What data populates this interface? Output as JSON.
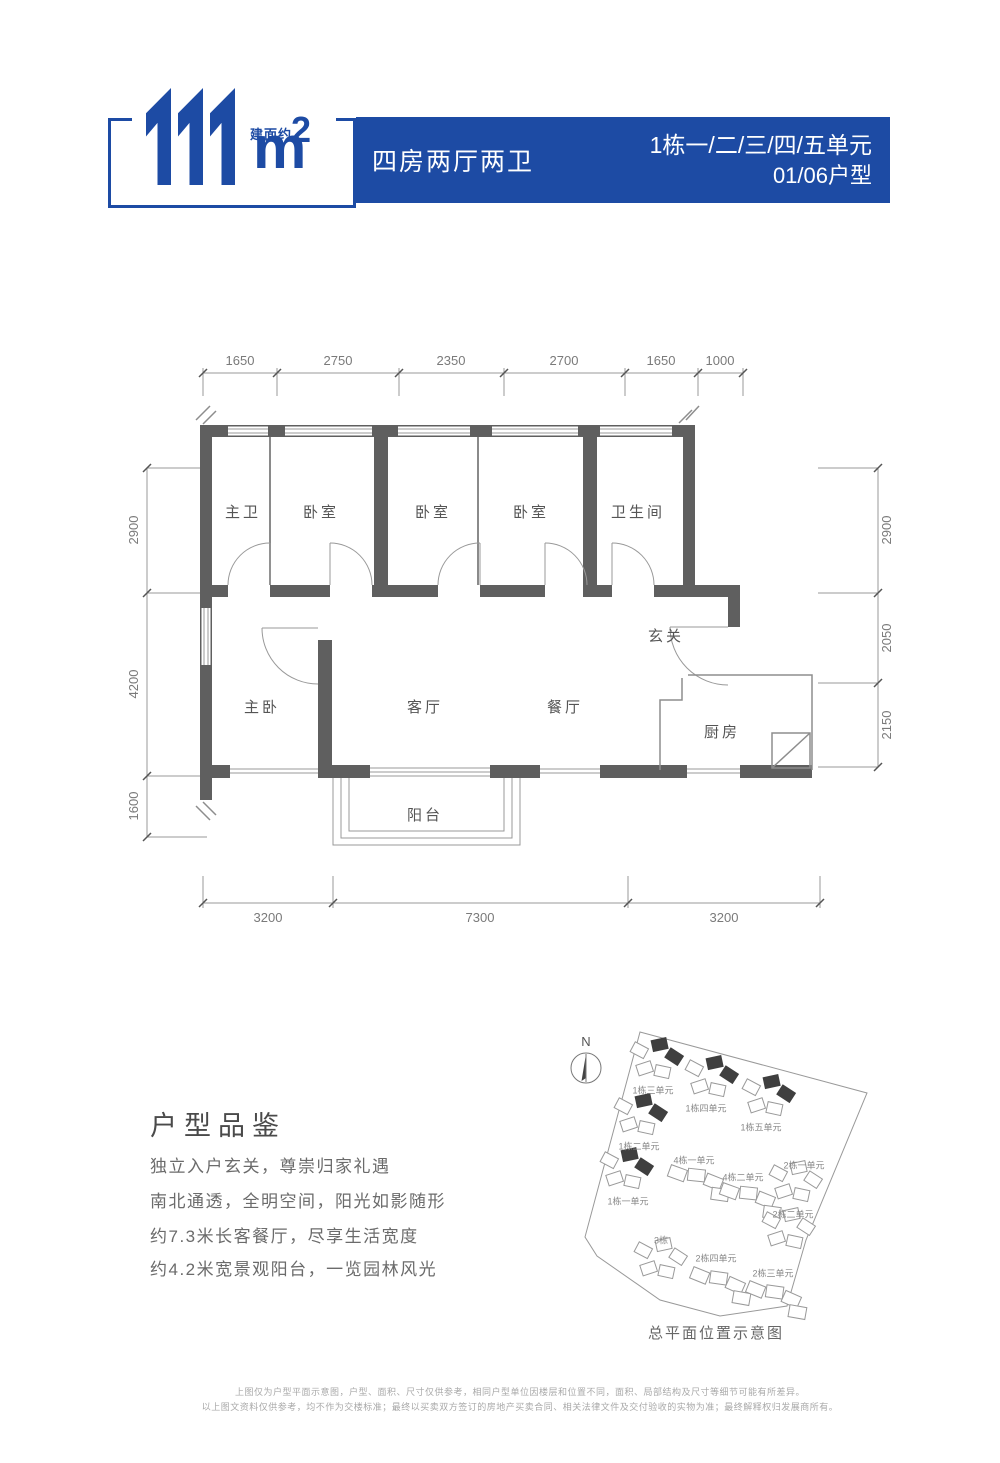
{
  "colors": {
    "brand_blue": "#1d4ba4",
    "wall_gray": "#5f5f5f"
  },
  "header": {
    "area_value": "111",
    "area_prefix": "建面约",
    "area_unit": "m",
    "area_sup": "2",
    "layout": "四房两厅两卫",
    "unit_line1": "1栋一/二/三/四/五单元",
    "unit_line2": "01/06户型"
  },
  "plan": {
    "rooms": {
      "master_bath": "主卫",
      "bedroom": "卧室",
      "bathroom": "卫生间",
      "foyer": "玄关",
      "master_bedroom": "主卧",
      "living": "客厅",
      "dining": "餐厅",
      "kitchen": "厨房",
      "balcony": "阳台"
    },
    "dims": {
      "top": [
        "1650",
        "2750",
        "2350",
        "2700",
        "1650",
        "1000"
      ],
      "left": [
        "2900",
        "4200",
        "1600"
      ],
      "right": [
        "2900",
        "2050",
        "2150"
      ],
      "bottom": [
        "3200",
        "7300",
        "3200"
      ]
    }
  },
  "intro": {
    "title": "户型品鉴",
    "lines": [
      "独立入户玄关，尊崇归家礼遇",
      "南北通透，全明空间，阳光如影随形",
      "约7.3米长客餐厅，尽享生活宽度",
      "约4.2米宽景观阳台，一览园林风光"
    ]
  },
  "site_plan": {
    "north": "N",
    "caption": "总平面位置示意图",
    "labels": [
      "1栋三单元",
      "1栋四单元",
      "1栋五单元",
      "1栋二单元",
      "4栋一单元",
      "2栋一单元",
      "4栋二单元",
      "1栋一单元",
      "2栋二单元",
      "3栋",
      "2栋四单元",
      "2栋三单元"
    ]
  },
  "footer": {
    "line1": "上图仅为户型平面示意图，户型、面积、尺寸仅供参考，相同户型单位因楼层和位置不同，面积、局部结构及尺寸等细节可能有所差异。",
    "line2": "以上图文资料仅供参考，均不作为交楼标准；最终以买卖双方签订的房地产买卖合同、相关法律文件及交付验收的实物为准；最终解释权归发展商所有。"
  }
}
